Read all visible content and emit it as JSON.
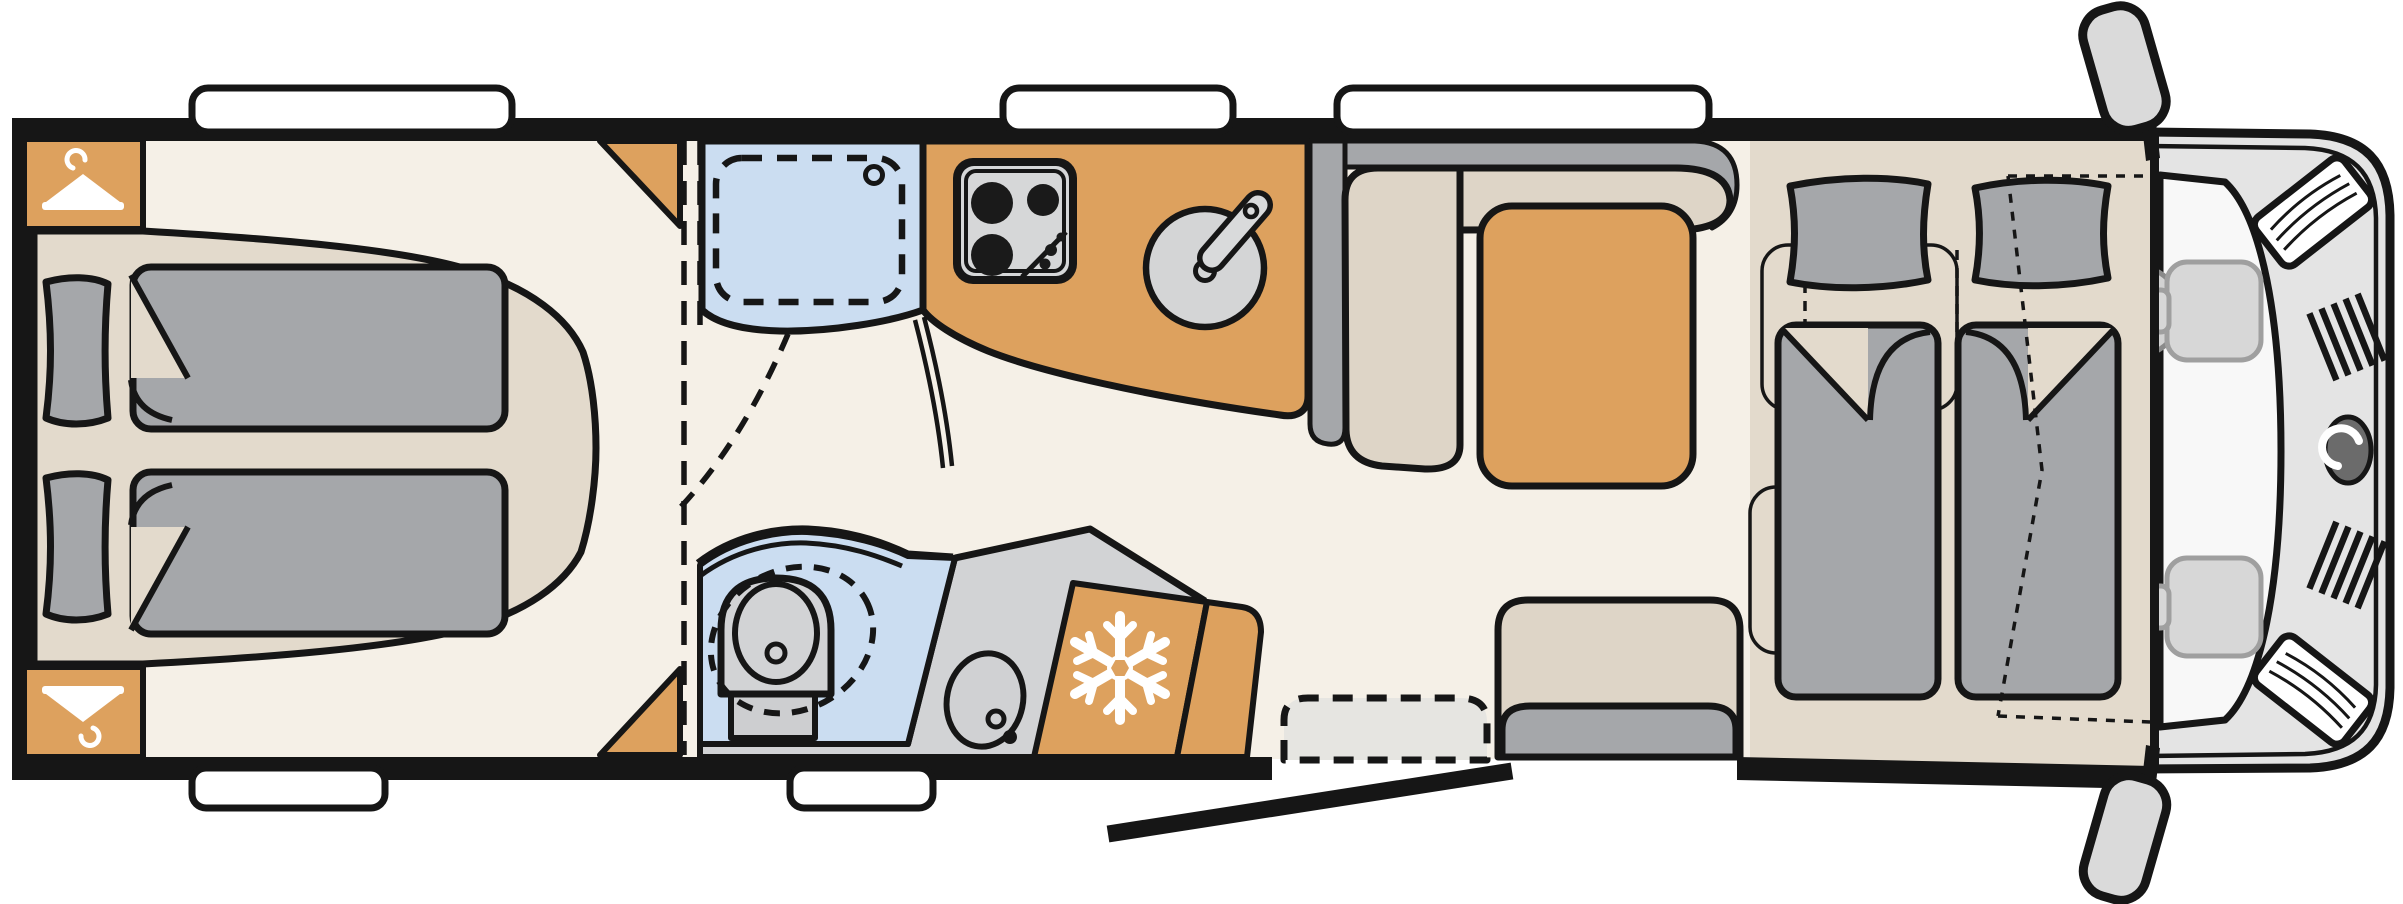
{
  "diagram": {
    "title": "Motorhome floor plan (top view)",
    "type": "vehicle-floor-plan",
    "orientation": "rear-left, cab-front-right",
    "visible_text": []
  },
  "colors": {
    "wall_black": "#161616",
    "floor_cream": "#f5f0e7",
    "surface_tan": "#e3dacc",
    "accent_wood": "#dda15e",
    "shower_blue": "#cbddf1",
    "bedding_gray": "#a5a7aa",
    "upholstery_beige": "#ded5c7",
    "fixture_gray": "#d2d3d5",
    "cab_gray": "#e4e4e4",
    "window_white": "#ffffff"
  },
  "rooms": [
    {
      "name": "rear-bedroom",
      "features": [
        "wardrobe-top",
        "wardrobe-bottom",
        "double-bed",
        "corner-shelf-top",
        "corner-shelf-bottom"
      ]
    },
    {
      "name": "bathroom",
      "features": [
        "shower-cabin",
        "toilet",
        "washbasin"
      ]
    },
    {
      "name": "kitchen",
      "features": [
        "hob-3-burner",
        "round-sink",
        "refrigerator"
      ]
    },
    {
      "name": "dinette",
      "features": [
        "l-bench",
        "table",
        "side-bench"
      ]
    },
    {
      "name": "entrance",
      "features": [
        "entry-door-open",
        "entry-step"
      ]
    },
    {
      "name": "front-bed-area",
      "features": [
        "twin-mattresses",
        "drop-down-bed-dashed-outline",
        "ladder-marking"
      ]
    },
    {
      "name": "cab",
      "features": [
        "driver-seat",
        "passenger-seat",
        "steering-wheel",
        "windshield",
        "wing-mirror-left",
        "wing-mirror-right",
        "grille",
        "headlights",
        "brand-logo"
      ]
    }
  ],
  "icons": [
    {
      "name": "coat-hanger-icon",
      "meaning": "wardrobe"
    },
    {
      "name": "snowflake-icon",
      "meaning": "refrigerator"
    },
    {
      "name": "hob-icon",
      "meaning": "cooker with 3 burners"
    },
    {
      "name": "sink-icon",
      "meaning": "kitchen sink with tap"
    },
    {
      "name": "toilet-icon",
      "meaning": "swivel toilet"
    },
    {
      "name": "washbasin-icon",
      "meaning": "bathroom basin"
    },
    {
      "name": "shower-tray-icon",
      "meaning": "shower"
    },
    {
      "name": "brand-logo-icon",
      "meaning": "manufacturer logo on cab front"
    }
  ],
  "counts": {
    "windows": 5,
    "pillows": 4,
    "duvets": 4,
    "wardrobes": 2,
    "cab_seats": 2,
    "wing_mirrors": 2
  }
}
